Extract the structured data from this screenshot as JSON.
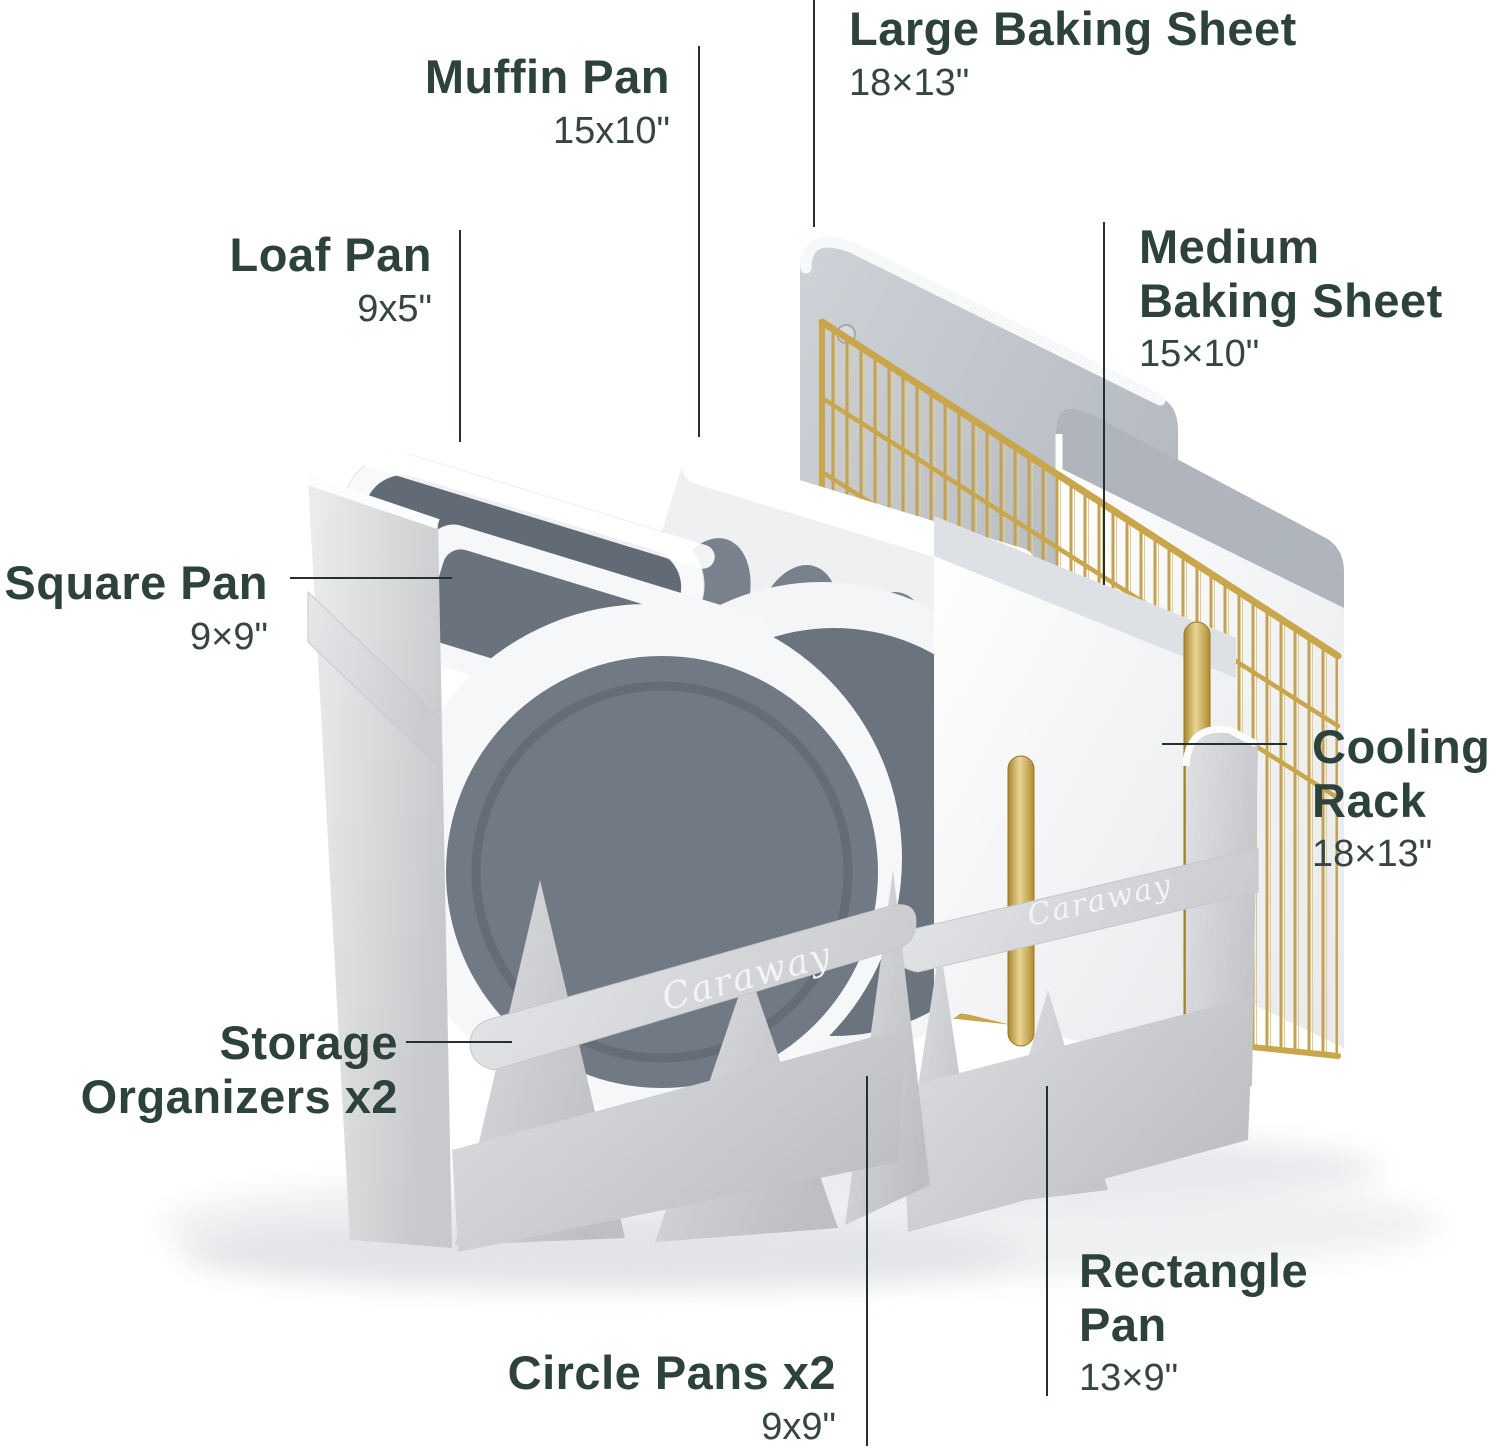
{
  "brand": "Caraway",
  "straps": {
    "left_label": "Caraway",
    "right_label": "Caraway"
  },
  "colors": {
    "label_text": "#2e423d",
    "dimension_text": "#36463f",
    "callout_line": "#25312e",
    "fabric": "#d6d7da",
    "strap": "#dcdde0",
    "gold": "#c2a050",
    "pan_white": "#f6f7f9",
    "pan_interior_gray": "#6b737e"
  },
  "labels": {
    "large_baking_sheet": {
      "name": "Large Baking Sheet",
      "size": "18×13\""
    },
    "muffin_pan": {
      "name": "Muffin Pan",
      "size": "15x10\""
    },
    "loaf_pan": {
      "name": "Loaf Pan",
      "size": "9x5\""
    },
    "medium_baking_sheet": {
      "name_line1": "Medium",
      "name_line2": "Baking Sheet",
      "size": "15×10\""
    },
    "square_pan": {
      "name": "Square Pan",
      "size": "9×9\""
    },
    "cooling_rack": {
      "name_line1": "Cooling",
      "name_line2": "Rack",
      "size": "18×13\""
    },
    "storage_organizers": {
      "name_line1": "Storage",
      "name_line2": "Organizers x2"
    },
    "circle_pans": {
      "name": "Circle Pans x2",
      "size": "9x9\""
    },
    "rectangle_pan": {
      "name_line1": "Rectangle",
      "name_line2": "Pan",
      "size": "13×9\""
    }
  }
}
